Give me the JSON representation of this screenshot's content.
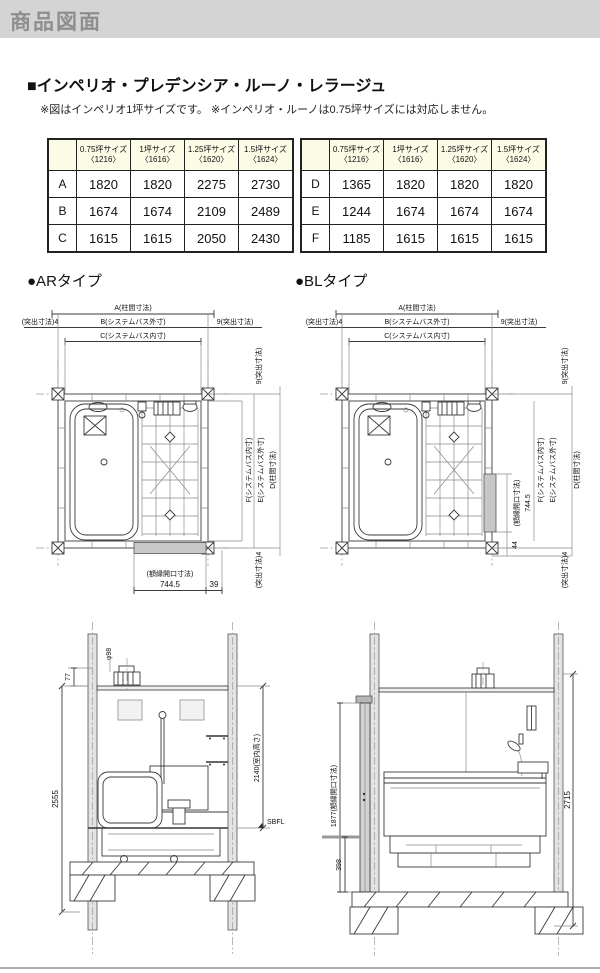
{
  "header": {
    "title": "商品図面"
  },
  "section": {
    "title": "■インペリオ・プレデンシア・ルーノ・レラージュ",
    "note": "※図はインペリオ1坪サイズです。 ※インペリオ・ルーノは0.75坪サイズには対応しません。"
  },
  "tables": {
    "col_headers": [
      [
        "0.75坪サイズ",
        "〈1216〉"
      ],
      [
        "1坪サイズ",
        "〈1616〉"
      ],
      [
        "1.25坪サイズ",
        "〈1620〉"
      ],
      [
        "1.5坪サイズ",
        "〈1624〉"
      ]
    ],
    "abc": [
      {
        "label": "A",
        "values": [
          "1820",
          "1820",
          "2275",
          "2730"
        ]
      },
      {
        "label": "B",
        "values": [
          "1674",
          "1674",
          "2109",
          "2489"
        ]
      },
      {
        "label": "C",
        "values": [
          "1615",
          "1615",
          "2050",
          "2430"
        ]
      }
    ],
    "def": [
      {
        "label": "D",
        "values": [
          "1365",
          "1820",
          "1820",
          "1820"
        ]
      },
      {
        "label": "E",
        "values": [
          "1244",
          "1674",
          "1674",
          "1674"
        ]
      },
      {
        "label": "F",
        "values": [
          "1185",
          "1615",
          "1615",
          "1615"
        ]
      }
    ]
  },
  "diagrams": {
    "ar_heading": "●ARタイプ",
    "bl_heading": "●BLタイプ"
  },
  "dims": {
    "a": "A(柱間寸法)",
    "b": "B(システムバス外寸)",
    "c": "C(システムバス内寸)",
    "d": "D(柱間寸法)",
    "e": "E(システムバス外寸)",
    "f": "F(システムバス内寸)",
    "protrude4": "(突出寸法)4",
    "protrude9": "9(突出寸法)",
    "frame_label": "(額縁開口寸法)",
    "frame_value": "744.5",
    "dim39": "39",
    "dim44": "44",
    "fan_dia": "φ98",
    "dim77": "77",
    "dim2555": "2555",
    "room_height": "2140(室内高さ)",
    "sbfl": "SBFL",
    "frame_1877": "1877(額縁開口寸法)",
    "dim398": "398",
    "dim2715": "2715"
  },
  "colors": {
    "band_bg": "#d4d4d4",
    "band_text": "#8e8e8e",
    "table_header_bg": "#fbfbe6"
  }
}
